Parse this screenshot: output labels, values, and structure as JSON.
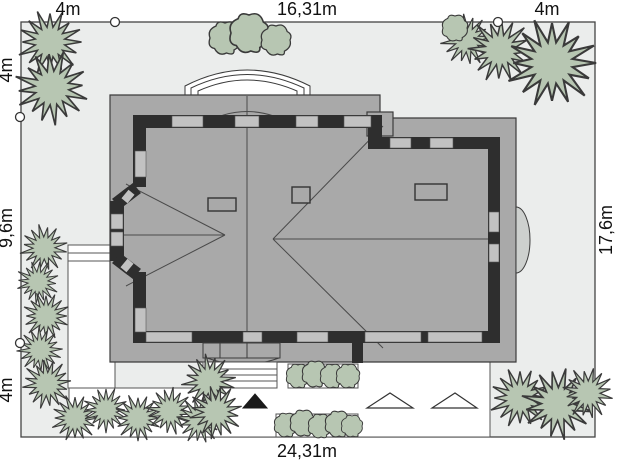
{
  "plan": {
    "type": "architectural-site-plan",
    "dimensions": {
      "top": [
        "4m",
        "16,31m",
        "4m"
      ],
      "left": [
        "4m",
        "9,6m",
        "4m"
      ],
      "right": [
        "17,6m"
      ],
      "bottom": [
        "24,31m"
      ]
    }
  },
  "colors": {
    "plot_background": "#ebedec",
    "roof_gray": "#a9a9a9",
    "wall_black": "#2e2e2e",
    "window_gray": "#c2c2c2",
    "vegetation_green": "#b7c6b2",
    "paving_white": "#ffffff",
    "outline": "#3c3c3c"
  },
  "markers": {
    "entrance_triangle": "filled-black-triangle",
    "parking_triangles": "outlined-white-triangles",
    "boundary_points": "white-circles"
  }
}
